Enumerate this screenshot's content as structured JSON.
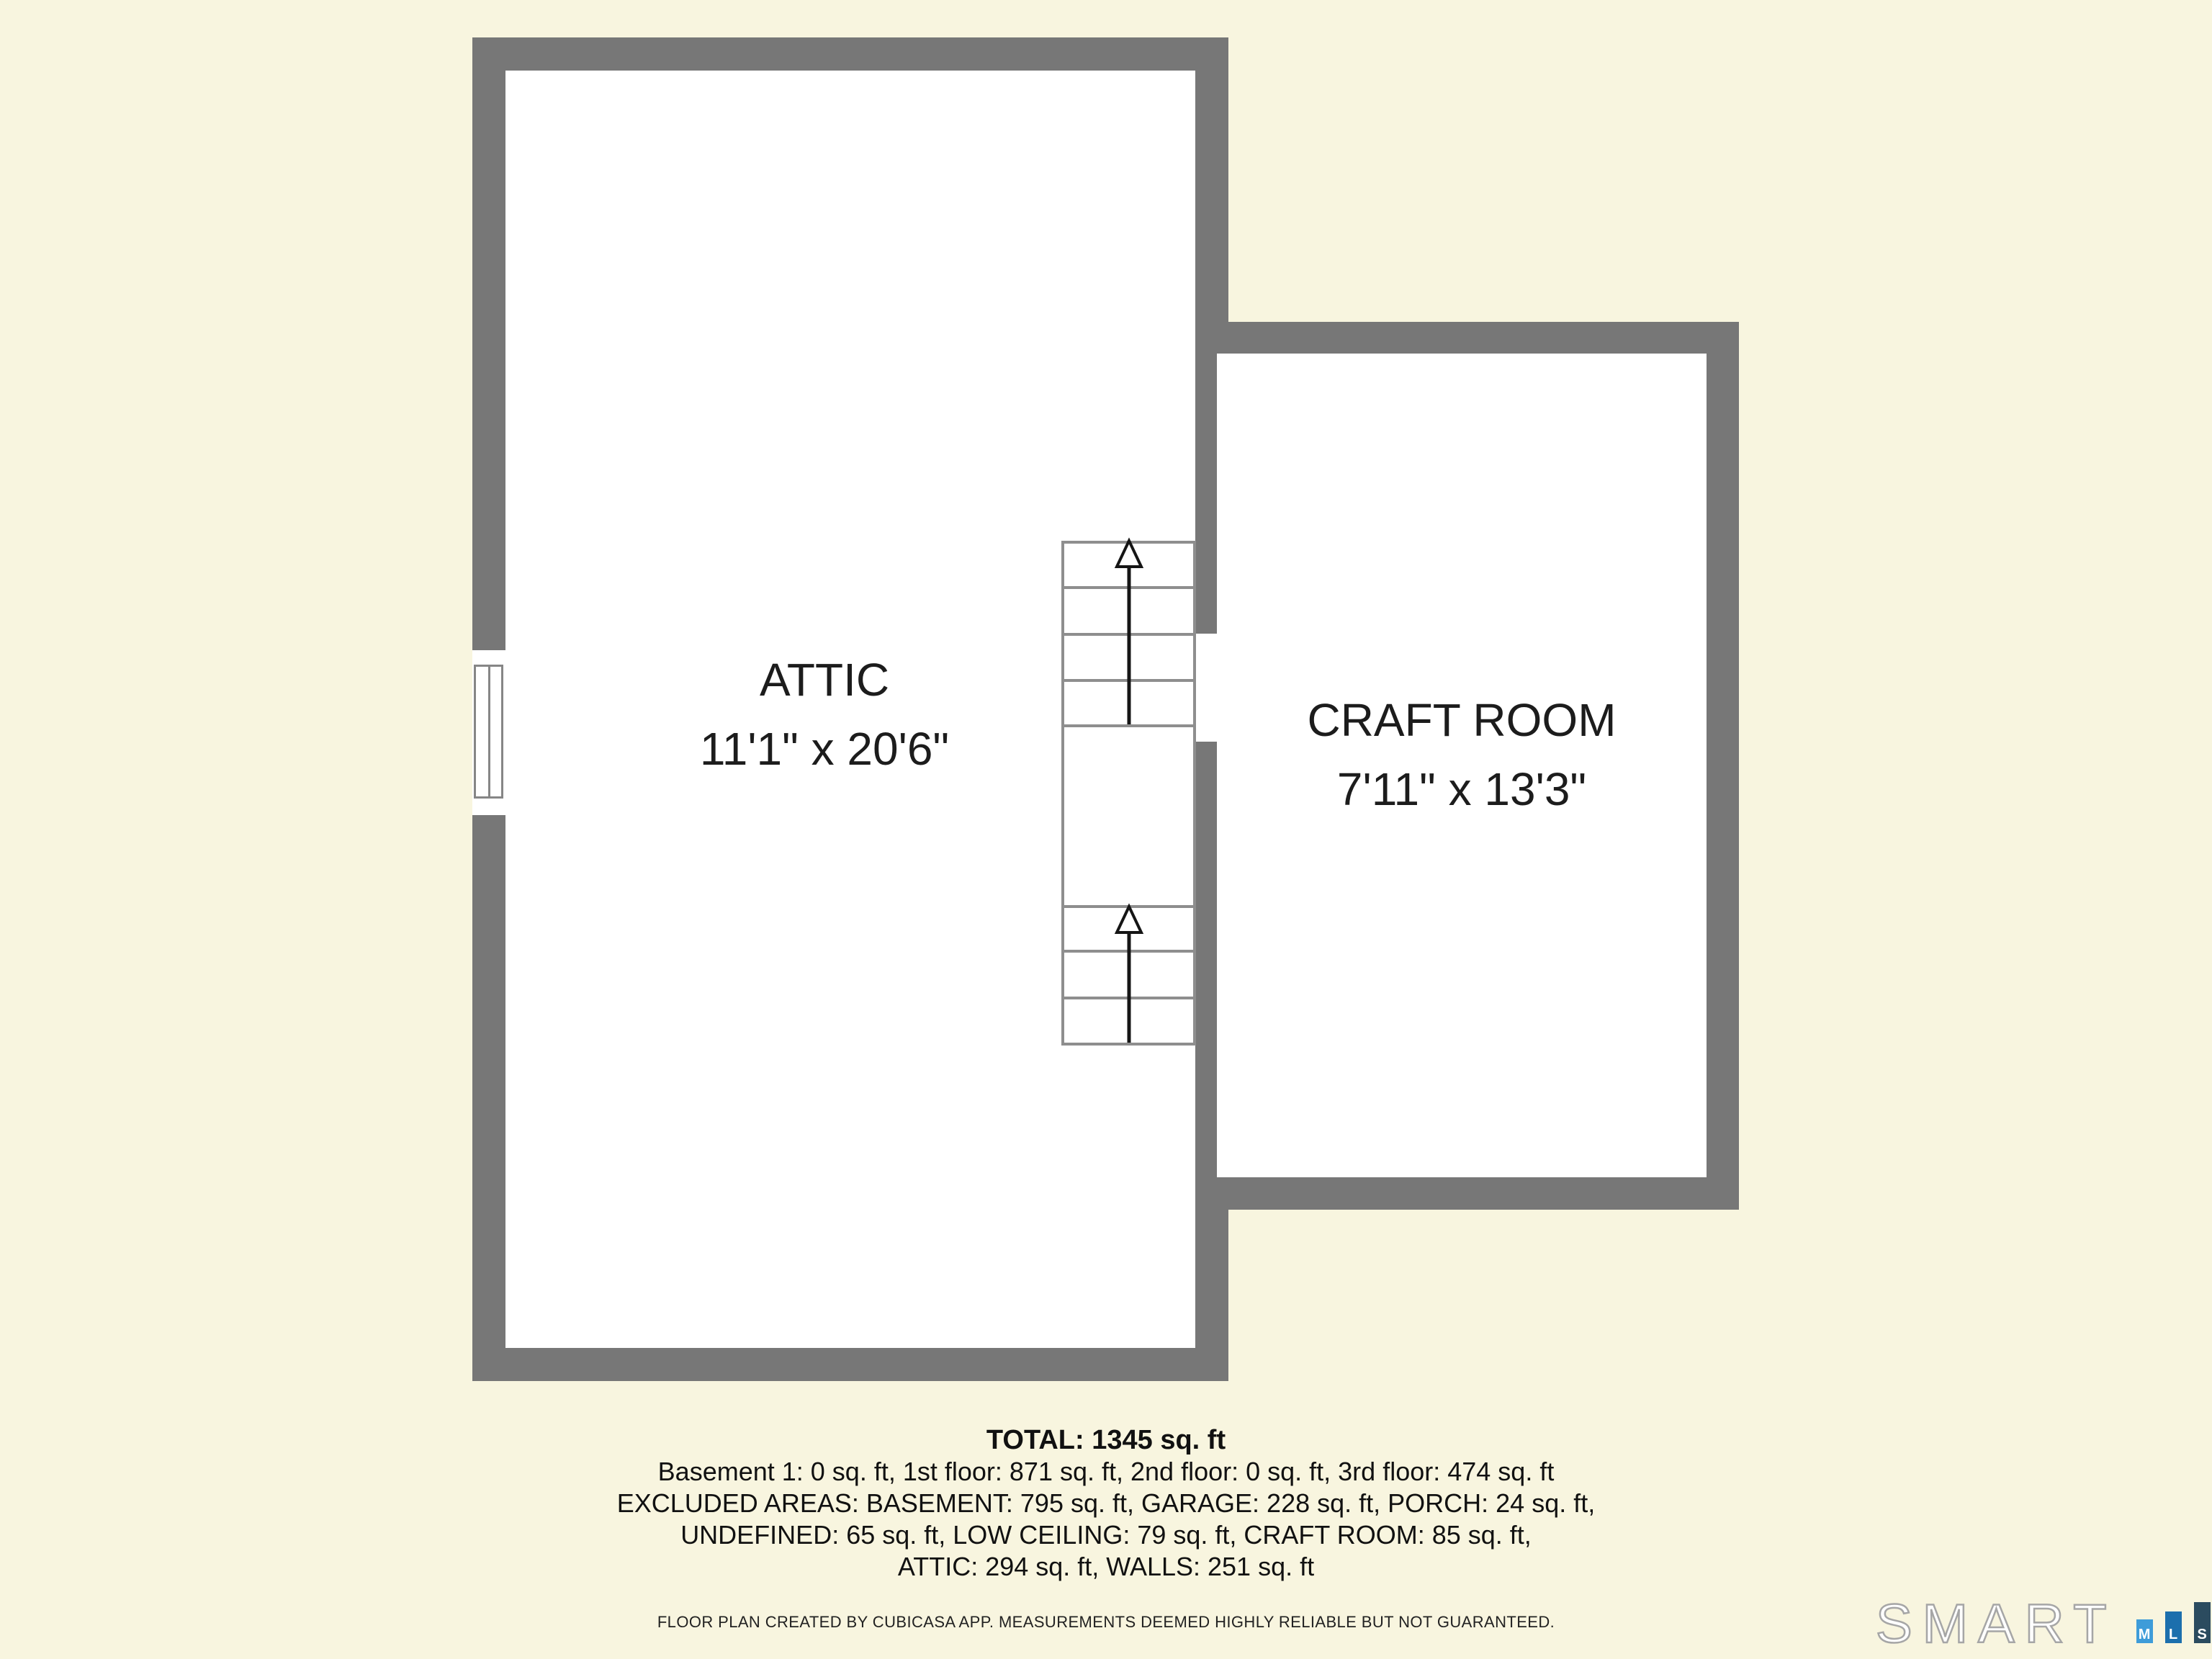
{
  "colors": {
    "background": "#F8F5DF",
    "wall": "#777777",
    "stair_line": "#8E8E8E",
    "arrow": "#151515",
    "room_fill": "#FFFFFF",
    "text": "#1C1C1C",
    "logo_m_bar": "#3E9CD9",
    "logo_l_bar": "#1C6FAD",
    "logo_s_bar": "#2B4B5F"
  },
  "plan": {
    "rooms": [
      {
        "label": "ATTIC",
        "dims": "11'1\" x 20'6\""
      },
      {
        "label": "CRAFT ROOM",
        "dims": "7'11\" x 13'3\""
      }
    ],
    "stairs": {
      "upper_treads": 4,
      "lower_treads": 3,
      "direction": "up"
    }
  },
  "summary": {
    "total": "TOTAL: 1345 sq. ft",
    "lines": [
      "Basement 1: 0 sq. ft, 1st floor: 871 sq. ft, 2nd floor: 0 sq. ft, 3rd floor: 474 sq. ft",
      "EXCLUDED AREAS: BASEMENT: 795 sq. ft, GARAGE: 228 sq. ft, PORCH: 24 sq. ft,",
      "UNDEFINED: 65 sq. ft, LOW CEILING: 79 sq. ft, CRAFT ROOM: 85 sq. ft,",
      "ATTIC: 294 sq. ft, WALLS: 251 sq. ft"
    ]
  },
  "disclaimer": "FLOOR PLAN CREATED BY CUBICASA APP. MEASUREMENTS DEEMED HIGHLY RELIABLE BUT NOT GUARANTEED.",
  "logo": {
    "brand": "SMART",
    "letters": [
      "M",
      "L",
      "S"
    ]
  }
}
